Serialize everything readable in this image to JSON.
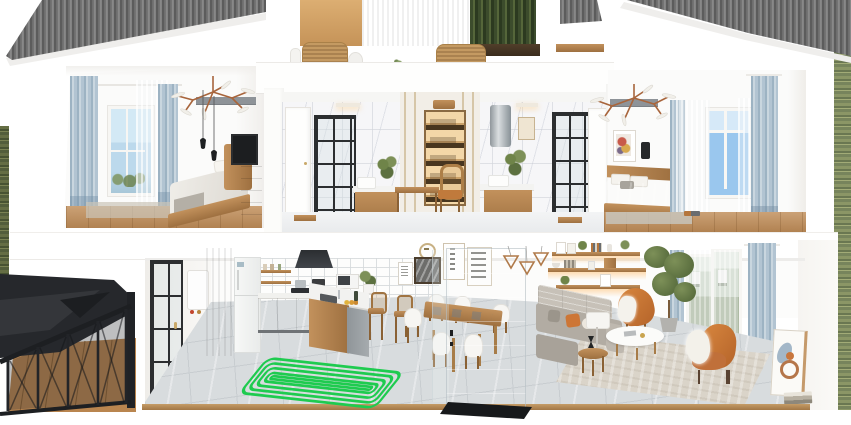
{
  "scene": {
    "type": "3d-cutaway-dollhouse-render",
    "subject": "two-story apartment cross-section with underfloor heating visualization",
    "floors": [
      {
        "name": "upper",
        "rooms": [
          "bedroom-left",
          "roof-terrace",
          "bathroom-left",
          "dressing-nook",
          "bathroom-right",
          "bedroom-right"
        ]
      },
      {
        "name": "ground",
        "rooms": [
          "exterior-staircase",
          "kitchen",
          "dining-area",
          "living-room"
        ]
      }
    ],
    "highlight": {
      "name": "underfloor-heating-coil",
      "room": "kitchen",
      "loops": 5
    }
  },
  "colors": {
    "coil_green": "#1ecb4f",
    "roof_mid": "#737373",
    "roof_dark": "#5c5c5c",
    "roof_light": "#8d8d8d",
    "wood_light": "#c2915c",
    "wood_dark": "#9e7040",
    "curtain_a": "#9db3c3",
    "curtain_b": "#c9d6df",
    "curtain_c": "#b2c4d2",
    "hedge_a": "#3c4c2c",
    "hedge_b": "#55663a",
    "hedge_c": "#2c3a20",
    "tile": "#d8dcde",
    "tile_line": "#c8cdd0",
    "orange_light": "#d8873f",
    "orange_dark": "#b5642a",
    "sofa_grey": "#b2aca3",
    "sofa_back": "#c7c1b8",
    "stair_black": "#26282c",
    "sky_light": "#d6e9f8",
    "sky_deep": "#9ac7ee"
  }
}
